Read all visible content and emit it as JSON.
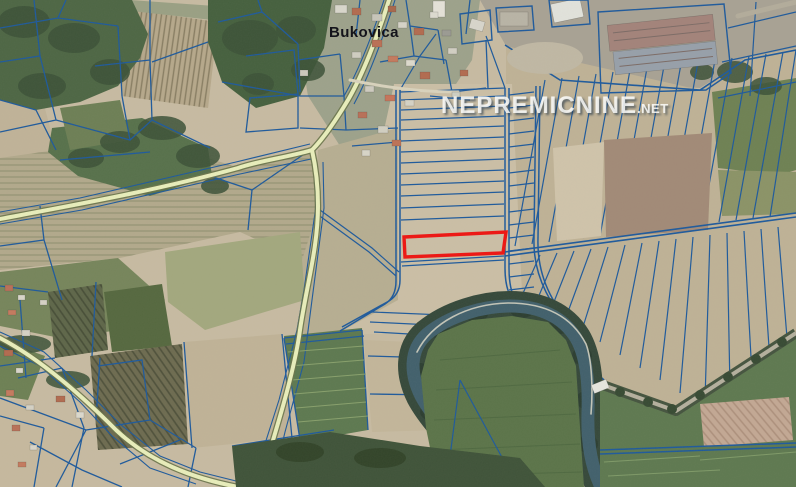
{
  "map": {
    "place_label": "Bukovica",
    "watermark_main": "NEPREMICNINE",
    "watermark_suffix": ".NET"
  },
  "colors": {
    "cadastral_line": "#1e5a9c",
    "highlight_parcel": "#ee1512",
    "road_fill": "#e9eebb",
    "river_water": "#41606c",
    "field_tan": "#c7bba2",
    "forest_green": "#4c6344"
  },
  "highlight_parcel": {
    "points": "404,237 506,232 503,253 405,257"
  }
}
